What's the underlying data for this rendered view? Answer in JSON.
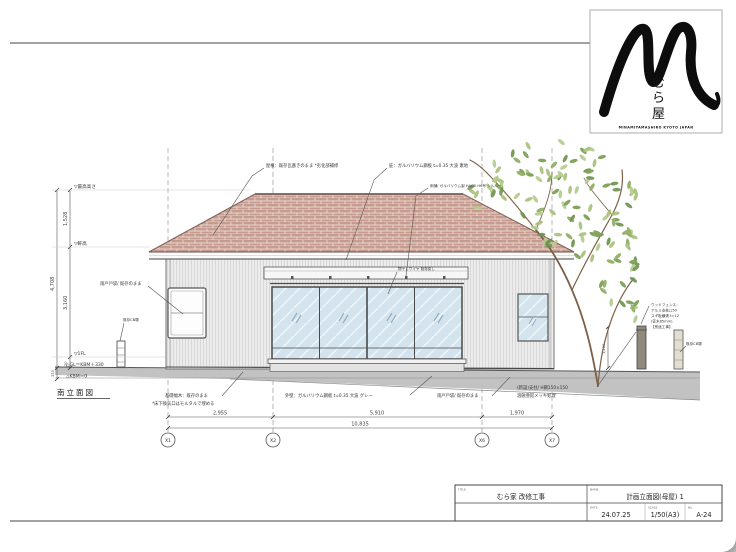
{
  "logo": {
    "mark": "calligraphy-M",
    "kanji_chars": [
      "む",
      "ら",
      "屋"
    ],
    "caption": "MINAMIYAMASHIRO KYOTO JAPAN"
  },
  "drawing_title": "南立面図",
  "levels": {
    "top": "▽最高高さ",
    "eave": "▽軒高",
    "fl": "▽1FL",
    "gl": "△GL＝KBM＋330",
    "kbm": "△KBM＝0"
  },
  "dims_left": {
    "overall": "4,708",
    "upper": "1,528",
    "middle": "3,160",
    "small": "20",
    "ground": "330"
  },
  "dims_bottom": {
    "segments": [
      "2,955",
      "5,910",
      "1,970"
    ],
    "overall": "10,835"
  },
  "grid_labels": [
    "X1",
    "X2",
    "X6",
    "X7"
  ],
  "fence_dim": "1,200",
  "annotations": {
    "roof": "屋根：既存瓦葺きのまま *劣化部補修",
    "hisashi": "庇：ガルバリウム鋼板 t=0.35 大波 素地",
    "gutter": "雨樋/ ガルバリウム製 HACO H6号 シルバー",
    "monohoshi": "物干しワイヤ 既存戻し",
    "amado_left": "雨戸戸袋/ 既存のまま",
    "cb_left": "既存CB塀",
    "cb_right": "既存CB塀",
    "base1": "基礎幅木：既存のまま",
    "base2": "*床下換気口はモルタルで埋める",
    "wall": "外壁：ガルバリウム鋼板 t=0.35 大波 グレー",
    "amado_bottom": "雨戸戸袋/ 既存のまま",
    "post1": "(新設)支柱/ H鋼150×150",
    "post2": "溶融亜鉛メッキ処理",
    "fence": [
      "ウッドフェンス：",
      "アルミ支柱□50",
      "スギ板横張 t=12",
      "(笠木85mm)",
      "【別途工事】"
    ]
  },
  "titleblock": {
    "title_label": "TITLE",
    "title": "むら家 改修工事",
    "name_label": "NAME",
    "name": "計画立面図(母屋) 1",
    "date_label": "DATE",
    "date": "24.07.25",
    "scale_label": "SCALE",
    "scale": "1/50(A3)",
    "no_label": "No.",
    "no": "A-24"
  },
  "colors": {
    "roof_tile": "#c79c90",
    "roof_edge": "#6b4f46",
    "wall": "#ececec",
    "glass": "#d3e4ef",
    "ground": "#c2c2c2",
    "leaf_green_dark": "#7a9e52",
    "leaf_green_light": "#a9c17b",
    "branch": "#7d6047",
    "line": "#444444"
  }
}
